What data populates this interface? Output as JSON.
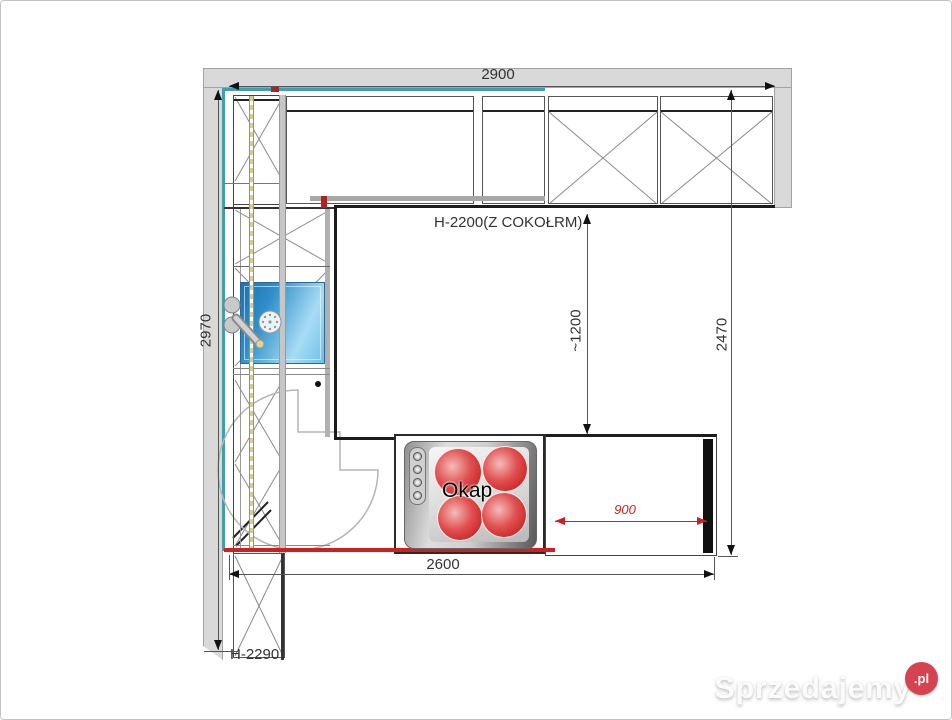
{
  "plan": {
    "dims": {
      "top": "2900",
      "left": "2970",
      "right": "2470",
      "bottom": "2600",
      "clearance": "~1200",
      "hood": "900"
    },
    "labels": {
      "upper_cabinets": "H-2200(Z COKOŁRM)",
      "hob": "Okap",
      "tall_cabinet": "H-2290"
    },
    "colors": {
      "wall": "#d9d9d9",
      "accent": "#3f9fae",
      "highlight_red": "#cf1f1f",
      "sink_blue": "#2e8fc9",
      "burner_red": "#c51a1a",
      "dashed_yellow": "#d9cc8e",
      "brand_red": "#d64350"
    }
  },
  "watermark": {
    "brand": "Sprzedajemy",
    "tld": ".pl"
  }
}
